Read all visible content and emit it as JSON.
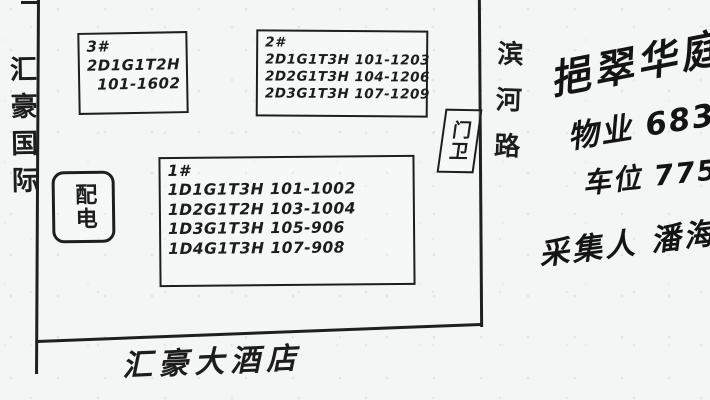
{
  "sketch": {
    "left_road_label": "汇豪国际",
    "bottom_label": "汇豪大酒店",
    "right_road_label": "滨河路",
    "guard_box_label": "门卫",
    "power_box_label": "配电",
    "buildings": [
      {
        "id": "3#",
        "lines": [
          "2D1G1T2H",
          "101-1602"
        ]
      },
      {
        "id": "2#",
        "lines": [
          "2D1G1T3H 101-1203",
          "2D2G1T3H 104-1206",
          "2D3G1T3H 107-1209"
        ]
      },
      {
        "id": "1#",
        "lines": [
          "1D1G1T3H 101-1002",
          "1D2G1T2H 103-1004",
          "1D3G1T3H 105-906",
          "1D4G1T3H 107-908"
        ]
      }
    ]
  },
  "notes": {
    "community_name": "挹翠华庭",
    "property_fee": "物业 68322",
    "parking_fee": "车位 775/月",
    "collector": "采集人 潘海"
  },
  "colors": {
    "ink": "#1d1d1d",
    "marker": "#141414",
    "paper": "#f3f6f5"
  }
}
